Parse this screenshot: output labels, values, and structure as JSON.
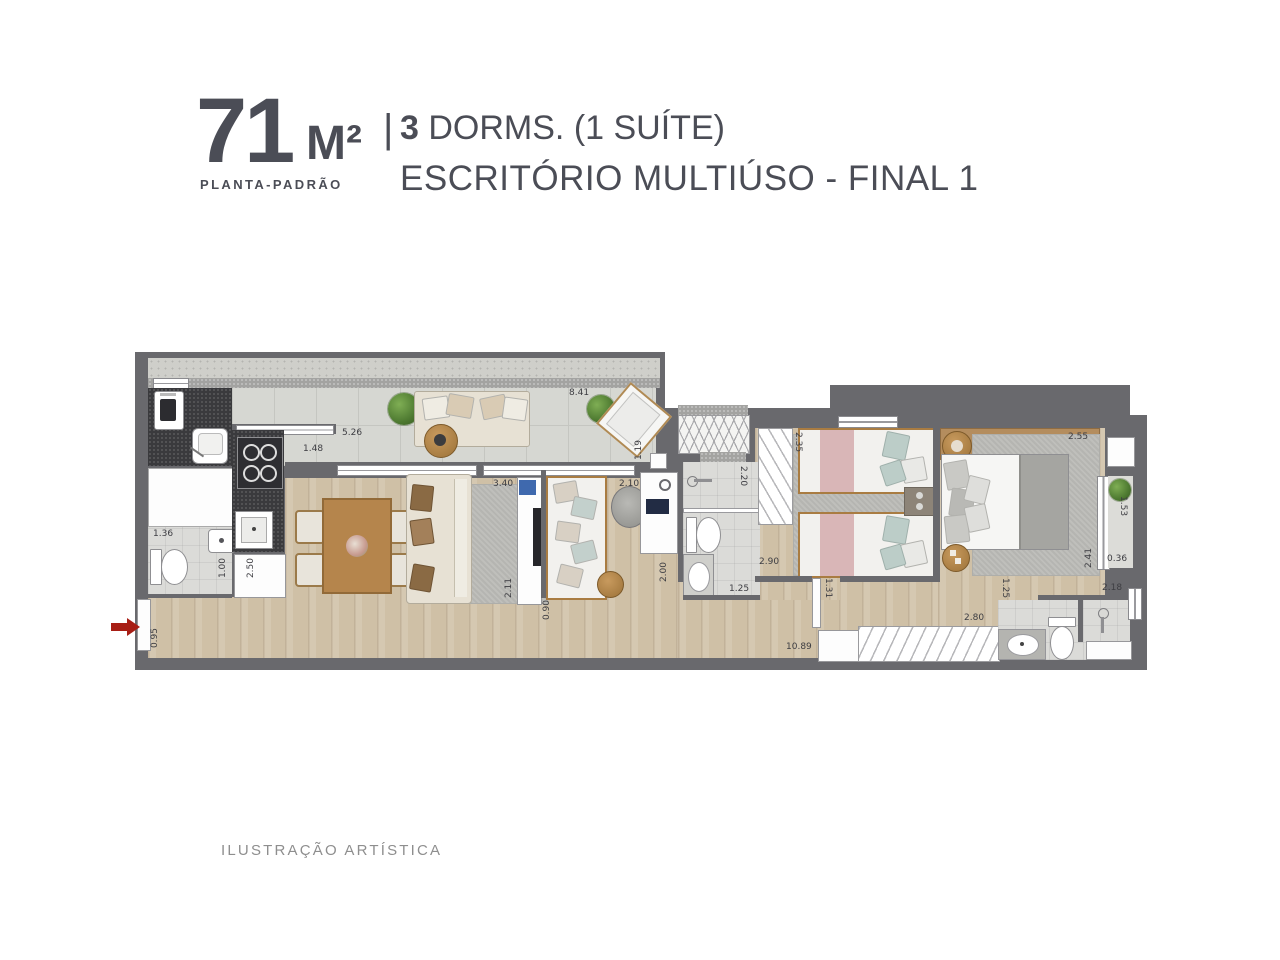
{
  "header": {
    "area_number": "71",
    "area_unit": "M²",
    "plan_type": "PLANTA-PADRÃO",
    "separator": "|",
    "dorms_bold": "3",
    "dorms_rest": " DORMS. (1 SUÍTE)",
    "subtitle": "ESCRITÓRIO MULTIÚSO - FINAL 1"
  },
  "footer": {
    "note": "ILUSTRAÇÃO ARTÍSTICA"
  },
  "plan": {
    "colors": {
      "wall": "#69696d",
      "wood_floor": "#cfc0a6",
      "balcony_tile": "#d6d7d2",
      "bath_floor": "#dbdbd8",
      "counter_dark": "#3a3a3d",
      "accent_red": "#a81e15",
      "title_text": "#4b4d56"
    },
    "dims": {
      "laundry_depth": "1.14",
      "kitchen_counter": "2.50",
      "bath1_width": "1.36",
      "bath1_depth": "1.00",
      "entry_width": "0.95",
      "balcony_seg1": "5.26",
      "kitchen_opening": "1.48",
      "balcony_length": "8.41",
      "balcony_end_depth": "1.19",
      "living_width": "3.40",
      "living_depth": "2.11",
      "office_width": "2.10",
      "office_opening": "0.90",
      "bath2_shower_depth": "2.20",
      "bath2_depth": "2.00",
      "bath2_width": "1.25",
      "twin_closet_depth": "2.35",
      "twin_opening": "2.90",
      "hall_opening": "1.31",
      "corridor_length": "10.89",
      "master_width": "2.55",
      "master_depth": "2.41",
      "master_balcony_depth": "1.53",
      "master_balcony_width": "0.36",
      "suite_bath_opening": "1.25",
      "suite_bath_width": "2.18",
      "master_wardrobe_width": "2.80"
    }
  }
}
